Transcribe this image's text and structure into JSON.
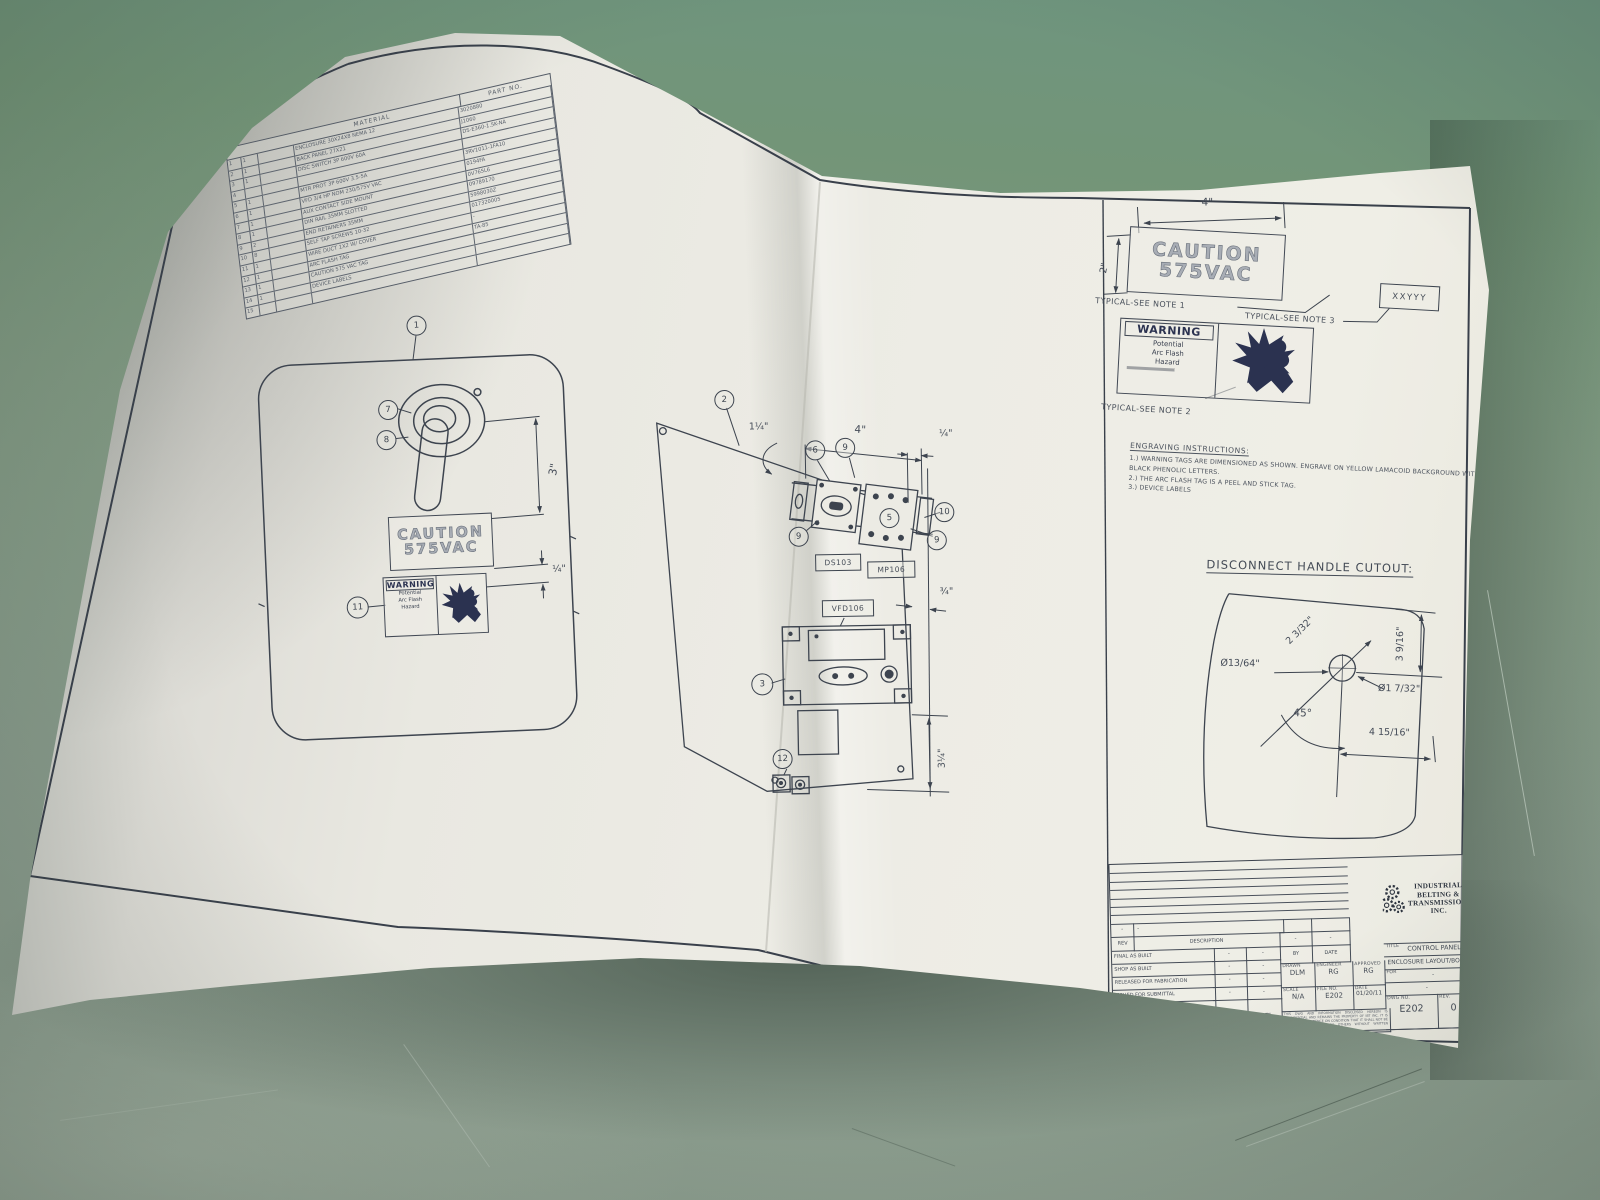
{
  "photo": {
    "surface_color": "#7b9680",
    "paper_color": "#ecebe4",
    "ink_color": "#3d444f",
    "warning_navy": "#2b3250"
  },
  "bom": {
    "header_material": "MATERIAL",
    "header_part_no": "PART NO.",
    "rows": [
      {
        "item": "1",
        "qty": "1",
        "desc": "ENCLOSURE 30X24X8 NEMA 12",
        "part": "3020880"
      },
      {
        "item": "2",
        "qty": "1",
        "desc": "BACK PANEL 27X21",
        "part": "J1060"
      },
      {
        "item": "3",
        "qty": "1",
        "desc": "DISC SWITCH 3P 600V 60A",
        "part": "DS-E360-1.5K-NA"
      },
      {
        "item": "4",
        "qty": "",
        "desc": "",
        "part": ""
      },
      {
        "item": "5",
        "qty": "1",
        "desc": "MTR PROT 3P 600V 3.5-5A",
        "part": "3RV1011-1FA10"
      },
      {
        "item": "6",
        "qty": "1",
        "desc": "VFD 3/4 HP NOM 230/575V VAC",
        "part": "0194FA"
      },
      {
        "item": "7",
        "qty": "1",
        "desc": "AUX CONTACT SIDE MOUNT",
        "part": "0V765L6"
      },
      {
        "item": "8",
        "qty": "1",
        "desc": "DIN RAIL 35MM SLOTTED",
        "part": "09789170"
      },
      {
        "item": "9",
        "qty": "2",
        "desc": "END RETAINERS 35MM",
        "part": "5998030Z"
      },
      {
        "item": "10",
        "qty": "8",
        "desc": "SELF TAP SCREWS 10-32",
        "part": "017320005"
      },
      {
        "item": "11",
        "qty": "1",
        "desc": "WIRE DUCT 1X2 W/ COVER",
        "part": "-"
      },
      {
        "item": "12",
        "qty": "1",
        "desc": "ARC FLASH TAG",
        "part": "TA-85"
      },
      {
        "item": "13",
        "qty": "1",
        "desc": "CAUTION 575 VAC TAG",
        "part": ""
      },
      {
        "item": "14",
        "qty": "1",
        "desc": "DEVICE LABELS",
        "part": ""
      },
      {
        "item": "15",
        "qty": "",
        "desc": "",
        "part": ""
      }
    ]
  },
  "door": {
    "balloon_1": "1",
    "balloon_7": "7",
    "balloon_8": "8",
    "balloon_11": "11",
    "caution_line1": "CAUTION",
    "caution_line2": "575VAC",
    "warning_title": "WARNING",
    "warning_l1": "Potential",
    "warning_l2": "Arc Flash",
    "warning_l3": "Hazard",
    "dim_handle": "3\"",
    "dim_gap": "¼\""
  },
  "panel": {
    "balloon_2": "2",
    "balloon_3": "3",
    "balloon_5": "5",
    "balloon_6": "6",
    "balloon_9": "9",
    "balloon_10": "10",
    "balloon_12": "12",
    "label_ds": "DS103",
    "label_mp": "MP106",
    "label_vfd": "VFD106",
    "dim_top": "4\"",
    "dim_left": "1¼\"",
    "dim_right": "¼\"",
    "dim_mid": "¾\"",
    "dim_bottom": "3¼\""
  },
  "details": {
    "dim_w": "4\"",
    "dim_h": "2\"",
    "caution_line1": "CAUTION",
    "caution_line2": "575VAC",
    "note1": "TYPICAL-SEE NOTE 1",
    "note2": "TYPICAL-SEE NOTE 2",
    "note3": "TYPICAL-SEE NOTE 3",
    "tag": "XXYYY",
    "warning_title": "WARNING",
    "warning_l1": "Potential",
    "warning_l2": "Arc Flash",
    "warning_l3": "Hazard",
    "engraving_header": "ENGRAVING INSTRUCTIONS:",
    "engraving_1": "1.) WARNING TAGS ARE DIMENSIONED AS SHOWN. ENGRAVE ON YELLOW LAMACOID BACKGROUND WITH BLACK PHENOLIC LETTERS.",
    "engraving_2": "2.) THE ARC FLASH TAG IS A PEEL AND STICK TAG.",
    "engraving_3": "3.) DEVICE LABELS"
  },
  "cutout": {
    "title": "DISCONNECT HANDLE CUTOUT:",
    "dim_diag": "2 3/32\"",
    "dim_right": "3 9/16\"",
    "dim_hole_small": "Ø13/64\"",
    "dim_hole_main": "Ø1 7/32\"",
    "dim_angle": "45°",
    "dim_bottom": "4 15/16\""
  },
  "titleblock": {
    "rev_header": "REV",
    "description_header": "DESCRIPTION",
    "by_header": "BY",
    "date_header": "DATE",
    "dash": "-",
    "status_rows": [
      {
        "label": "FINAL AS BUILT",
        "c1": "-",
        "c2": "-"
      },
      {
        "label": "SHOP AS BUILT",
        "c1": "-",
        "c2": "-"
      },
      {
        "label": "RELEASED FOR FABRICATION",
        "c1": "-",
        "c2": "-"
      },
      {
        "label": "ISSUED FOR SUBMITTAL",
        "c1": "-",
        "c2": "-"
      },
      {
        "label": "DRAWING STATUS",
        "c1": "BY",
        "c2": "DATE"
      }
    ],
    "drawn_label": "DRAWN",
    "drawn_value": "DLM",
    "engineer_label": "ENGINEER",
    "engineer_value": "RG",
    "approved_label": "APPROVED",
    "approved_value": "RG",
    "scale_label": "SCALE",
    "scale_value": "N/A",
    "file_label": "FILE NO.",
    "file_value": "E202",
    "date_label": "DATE",
    "date_value": "01/20/11",
    "company_l1": "INDUSTRIAL",
    "company_l2": "BELTING &",
    "company_l3": "TRANSMISSION, INC.",
    "title_label": "TITLE",
    "title_l1": "CONTROL PANEL",
    "title_l2": "ENCLOSURE LAYOUT/BOM",
    "for_label": "FOR",
    "for_l1": "-",
    "for_l2": "-",
    "dwg_label": "DWG NO.",
    "dwg_value": "E202",
    "rev_label": "REV.",
    "rev_value": "0",
    "fine_print": "THIS DWG AND INFORMATION DISCLOSED HEREON IS CONFIDENTIAL AND REMAINS THE PROPERTY OF IBT INC. IT IS LOANED IN CONFIDENCE ON CONDITION THAT IT SHALL NOT BE COPIED OR DISCLOSED TO OTHERS WITHOUT WRITTEN AUTHORIZATION FROM IBT."
  }
}
